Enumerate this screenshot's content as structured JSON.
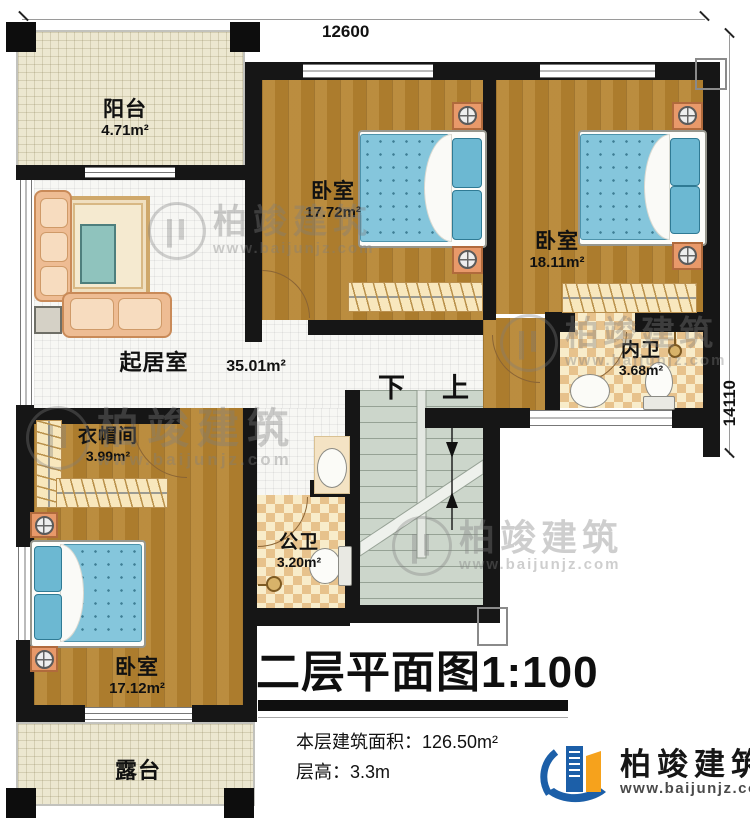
{
  "dimensions": {
    "top": "12600",
    "right": "14110"
  },
  "rooms": {
    "balcony": {
      "name": "阳台",
      "area": "4.71m²"
    },
    "bedroom_top": {
      "name": "卧室",
      "area": "17.72m²"
    },
    "bedroom_right": {
      "name": "卧室",
      "area": "18.11m²"
    },
    "living": {
      "name": "起居室",
      "area": "35.01m²"
    },
    "ensuite": {
      "name": "内卫",
      "area": "3.68m²"
    },
    "closet": {
      "name": "衣帽间",
      "area": "3.99m²"
    },
    "bath": {
      "name": "公卫",
      "area": "3.20m²"
    },
    "bedroom_bottom": {
      "name": "卧室",
      "area": "17.12m²"
    },
    "terrace": {
      "name": "露台"
    }
  },
  "stairs": {
    "down": "下",
    "up": "上"
  },
  "title_block": {
    "title": "二层平面图1:100",
    "area_label": "本层建筑面积：",
    "area_value": "126.50m²",
    "height_label": "层高：",
    "height_value": "3.3m"
  },
  "branding": {
    "brand": "柏竣建筑",
    "website": "www.baijunjz.com"
  },
  "colors": {
    "wall": "#161616",
    "wood": "#b5832f",
    "tile": "#e7c28c",
    "stairs": "#ccd6cb",
    "mattress": "#85c6dc",
    "brand_blue": "#1c5fa8",
    "brand_orange": "#f6a21c"
  }
}
